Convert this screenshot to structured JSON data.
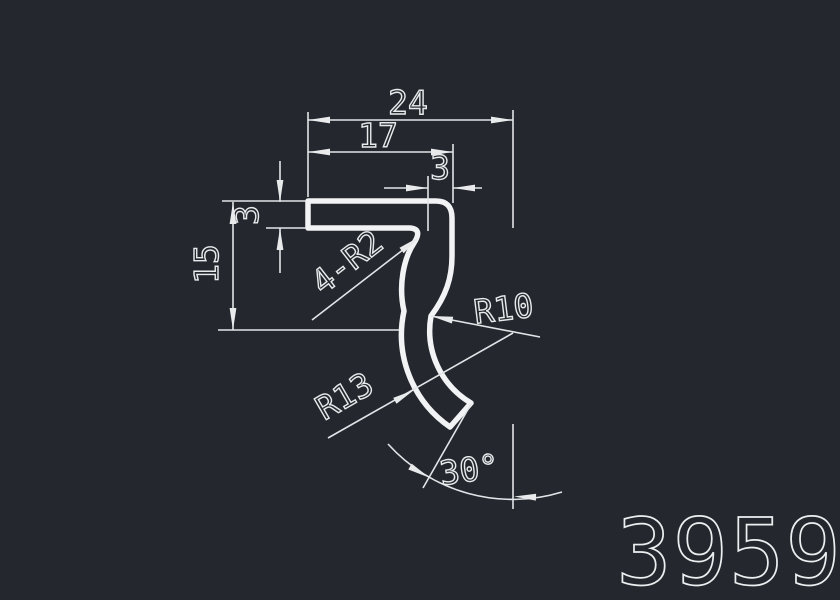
{
  "drawing": {
    "type": "profile-cross-section",
    "part_number": "3959",
    "labels": {
      "overall_width": "24",
      "flange_length": "17",
      "leg_width": "3",
      "height": "15",
      "thickness": "3",
      "corner_radii": "4-R2",
      "inner_radius": "R10",
      "outer_radius": "R13",
      "end_angle": "30°"
    },
    "colors": {
      "background": "#24282e",
      "line": "#e8eaec",
      "profile_line": "#f2f3f4"
    }
  }
}
